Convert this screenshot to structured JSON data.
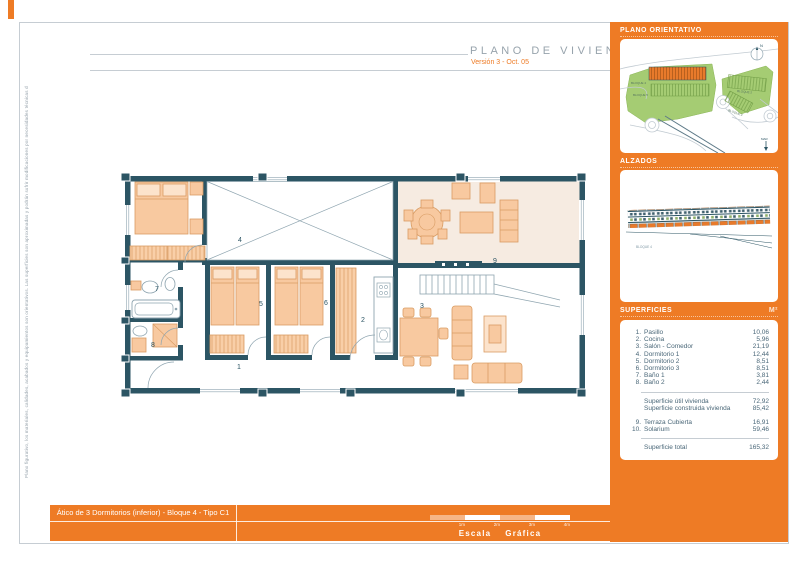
{
  "page": {
    "title": "PLANO DE VIVIENDA",
    "subtitle": "Versión 3 - Oct. 05",
    "margin_note": "Plano figurativo, los materiales, calidades, acabados y equipamientos son orientativos. Las superficies son aproximadas y podrán sufrir modificaciones por necesidades técnicas durante la ejecución de la obra."
  },
  "footer": {
    "caption": "Ático de 3 Dormitorios (inferior) - Bloque 4 - Tipo C1",
    "scale": {
      "labels": [
        "1m",
        "2m",
        "3m",
        "4m"
      ],
      "word1": "Escala",
      "word2": "Gráfica"
    }
  },
  "sidebar": {
    "orientation": {
      "title": "PLANO ORIENTATIVO",
      "north_label": "N",
      "sea_label": "MAR",
      "blocks": [
        "BLOQUE 4",
        "BLOQUE 5",
        "BLOQUE 2",
        "BLOQUE 3"
      ]
    },
    "elevations": {
      "title": "ALZADOS",
      "block_label": "BLOQUE 4"
    },
    "areas": {
      "title": "SUPERFICIES",
      "unit": "M²",
      "rooms": [
        {
          "num": "1.",
          "label": "Pasillo",
          "value": "10,06"
        },
        {
          "num": "2.",
          "label": "Cocina",
          "value": "5,96"
        },
        {
          "num": "3.",
          "label": "Salón - Comedor",
          "value": "21,19"
        },
        {
          "num": "4.",
          "label": "Dormitorio 1",
          "value": "12,44"
        },
        {
          "num": "5.",
          "label": "Dormitorio 2",
          "value": "8,51"
        },
        {
          "num": "6.",
          "label": "Dormitorio 3",
          "value": "8,51"
        },
        {
          "num": "7.",
          "label": "Baño 1",
          "value": "3,81"
        },
        {
          "num": "8.",
          "label": "Baño 2",
          "value": "2,44"
        }
      ],
      "subtotals": [
        {
          "label": "Superficie útil vivienda",
          "value": "72,92"
        },
        {
          "label": "Superficie construida vivienda",
          "value": "85,42"
        }
      ],
      "extras": [
        {
          "num": "9.",
          "label": "Terraza Cubierta",
          "value": "16,91"
        },
        {
          "num": "10.",
          "label": "Solarium",
          "value": "59,46"
        }
      ],
      "total": {
        "label": "Superficie total",
        "value": "165,32"
      }
    }
  },
  "plan": {
    "room_numbers": [
      "1",
      "2",
      "3",
      "4",
      "5",
      "6",
      "7",
      "8",
      "9"
    ]
  },
  "colors": {
    "accent": "#EE7B25",
    "wall": "#2C5564",
    "furniture": "#F9CFA8",
    "green": "#A5CC73"
  }
}
